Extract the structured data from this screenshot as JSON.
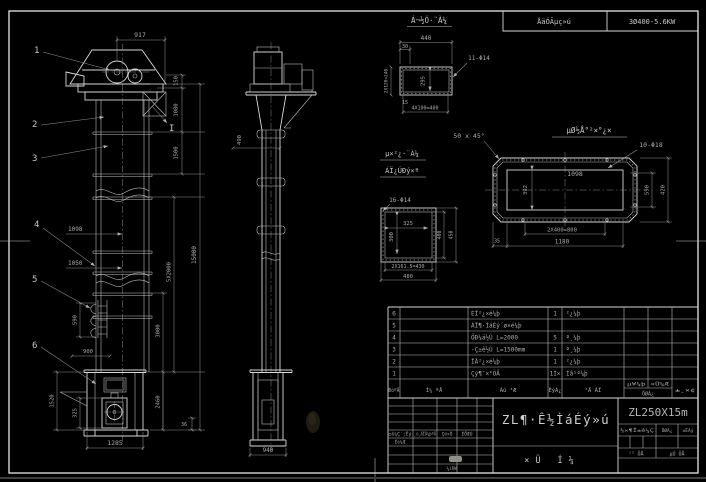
{
  "header": {
    "motor_label": "ÅäÓÃµç»ú",
    "motor_spec": "3Ø400-5.6KW"
  },
  "front": {
    "c1": "1",
    "c2": "2",
    "c3": "3",
    "c4": "4",
    "c5": "5",
    "c6": "6",
    "section_mark": "I",
    "d917": "917",
    "d150": "150",
    "d1080": "1080",
    "d1500": "1500",
    "d15000": "15000",
    "d5x2000": "5X2000",
    "d1098": "1098",
    "d1050": "1050",
    "d590": "590",
    "d900": "900",
    "d1520": "1520",
    "d325": "325",
    "d3000": "3000",
    "d2460": "2460",
    "d36": "36",
    "d1285": "1285"
  },
  "side": {
    "d490": "490",
    "d940": "940"
  },
  "detail_channel": {
    "title": "Á¬½Ó·¨À¼",
    "d440": "440",
    "d30": "30",
    "holes": "11-Φ14",
    "d295": "295",
    "d15": "15",
    "d4x100": "4X100=400",
    "d2x120": "2X120=240"
  },
  "detail_square": {
    "title1": "µ×²¿·¨À¼",
    "title2": "ÁÏ¿ÚÐý×ª",
    "holes": "16-Φ14",
    "d325": "325",
    "d300": "300",
    "d400": "400",
    "d450": "450",
    "d2x161": "2X161.5=430",
    "d480": "480"
  },
  "detail_flange": {
    "title": "µØ½Å°²×°¿×",
    "chamfer": "50 x 45°",
    "holes": "10-Φ18",
    "d1098": "1098",
    "d392": "392",
    "d590": "590",
    "d420": "420",
    "d2x400": "2X400=800",
    "d1180": "1180",
    "d35": "35"
  },
  "parts": {
    "headers": {
      "seq": "ÐòºÅ",
      "code": "Í¼ ºÅ",
      "name": "Ãû ³Æ",
      "qty": "ÊýÁ¿",
      "material": "²Ä ÁÏ",
      "weight_top": "µ¥¼þ ×Ü¼Æ",
      "weight_bottom": "ÖØÁ¿",
      "note": "±¸×¢"
    },
    "rows": [
      {
        "seq": "6",
        "code": "",
        "name": "ÉÏ²¿×é¼þ",
        "qty": "1",
        "material": "²¿¼þ"
      },
      {
        "seq": "5",
        "code": "",
        "name": "ÁÏ¶·ÌáÉý´ø×é¼þ",
        "qty": "",
        "material": ""
      },
      {
        "seq": "4",
        "code": "",
        "name": "ÖÐ¼ä½Ú L=2000",
        "qty": "5",
        "material": "º¸¼þ"
      },
      {
        "seq": "3",
        "code": "",
        "name": "·Ç±ê½Ú L=1500mm",
        "qty": "1",
        "material": "º¸¼þ"
      },
      {
        "seq": "2",
        "code": "",
        "name": "ÏÂ²¿×é¼þ",
        "qty": "1",
        "material": "²¿¼þ"
      },
      {
        "seq": "1",
        "code": "",
        "name": "Çý¶¯×°ÖÃ",
        "qty": "1Ì×",
        "material": "Íâ¹º¼þ"
      }
    ]
  },
  "tb": {
    "title": "ZL¶·Ê½ÌáÉý»ú",
    "subtitle": "×Ü Í¼",
    "model": "ZL250X15m",
    "rev1": "±ê¼Ç´¦Êý",
    "rev2": "¸ü¸ÄÎÄ¼þºÅ",
    "rev3": "Ç©×Ö",
    "rev4": "ÈÕÆÚ",
    "design": "Éè¼Æ",
    "check": "¼ìÑé",
    "stage": "½×¶Î±ê¼Ç",
    "weight": "ÖØÁ¿",
    "scale": "±ÈÀý",
    "sheet_total": "¹²  ÕÅ",
    "sheet_no": "µÚ  ÕÅ"
  }
}
